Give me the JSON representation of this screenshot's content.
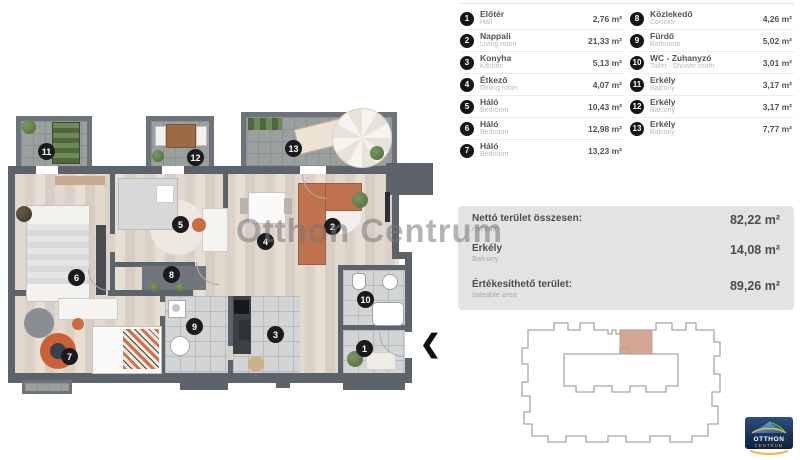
{
  "legend": {
    "items": [
      {
        "num": "1",
        "name": "Előtér",
        "name_en": "Hall",
        "area": "2,76 m²"
      },
      {
        "num": "2",
        "name": "Nappali",
        "name_en": "Living room",
        "area": "21,33 m²"
      },
      {
        "num": "3",
        "name": "Konyha",
        "name_en": "Kitchen",
        "area": "5,13 m²"
      },
      {
        "num": "4",
        "name": "Étkező",
        "name_en": "Dining room",
        "area": "4,07 m²"
      },
      {
        "num": "5",
        "name": "Háló",
        "name_en": "Bedroom",
        "area": "10,43 m²"
      },
      {
        "num": "6",
        "name": "Háló",
        "name_en": "Bedroom",
        "area": "12,98 m²"
      },
      {
        "num": "7",
        "name": "Háló",
        "name_en": "Bedroom",
        "area": "13,23 m²"
      },
      {
        "num": "8",
        "name": "Közlekedő",
        "name_en": "Corridor",
        "area": "4,26 m²"
      },
      {
        "num": "9",
        "name": "Fürdő",
        "name_en": "Bathroom",
        "area": "5,02 m²"
      },
      {
        "num": "10",
        "name": "WC - Zuhanyzó",
        "name_en": "Toilet - Shower room",
        "area": "3,01 m²"
      },
      {
        "num": "11",
        "name": "Erkély",
        "name_en": "Balcony",
        "area": "3,17 m²"
      },
      {
        "num": "12",
        "name": "Erkély",
        "name_en": "Balcony",
        "area": "3,17 m²"
      },
      {
        "num": "13",
        "name": "Erkély",
        "name_en": "Balcony",
        "area": "7,77 m²"
      }
    ]
  },
  "summary": {
    "rows": [
      {
        "label": "Nettó terület összesen:",
        "label_en": "net sum",
        "value": "82,22 m²"
      },
      {
        "label": "Erkély",
        "label_en": "Balcony",
        "value": "14,08 m²"
      },
      {
        "label": "Értékesíthető terület:",
        "label_en": "saleable area",
        "value": "89,26 m²"
      }
    ]
  },
  "watermark": "Otthon Centrum",
  "entrance": {
    "arrow": "❮"
  },
  "logo": {
    "line1": "OTTHON",
    "line2": "CENTRUM"
  },
  "colors": {
    "wall": "#5d636b",
    "wood": "#ddd3c9",
    "balcony_tile": "#9aa09e",
    "sofa": "#c0714e",
    "highlight_unit": "#d5a694",
    "marker": "#1b1b1d",
    "summary_bg": "#e3e3e3"
  }
}
